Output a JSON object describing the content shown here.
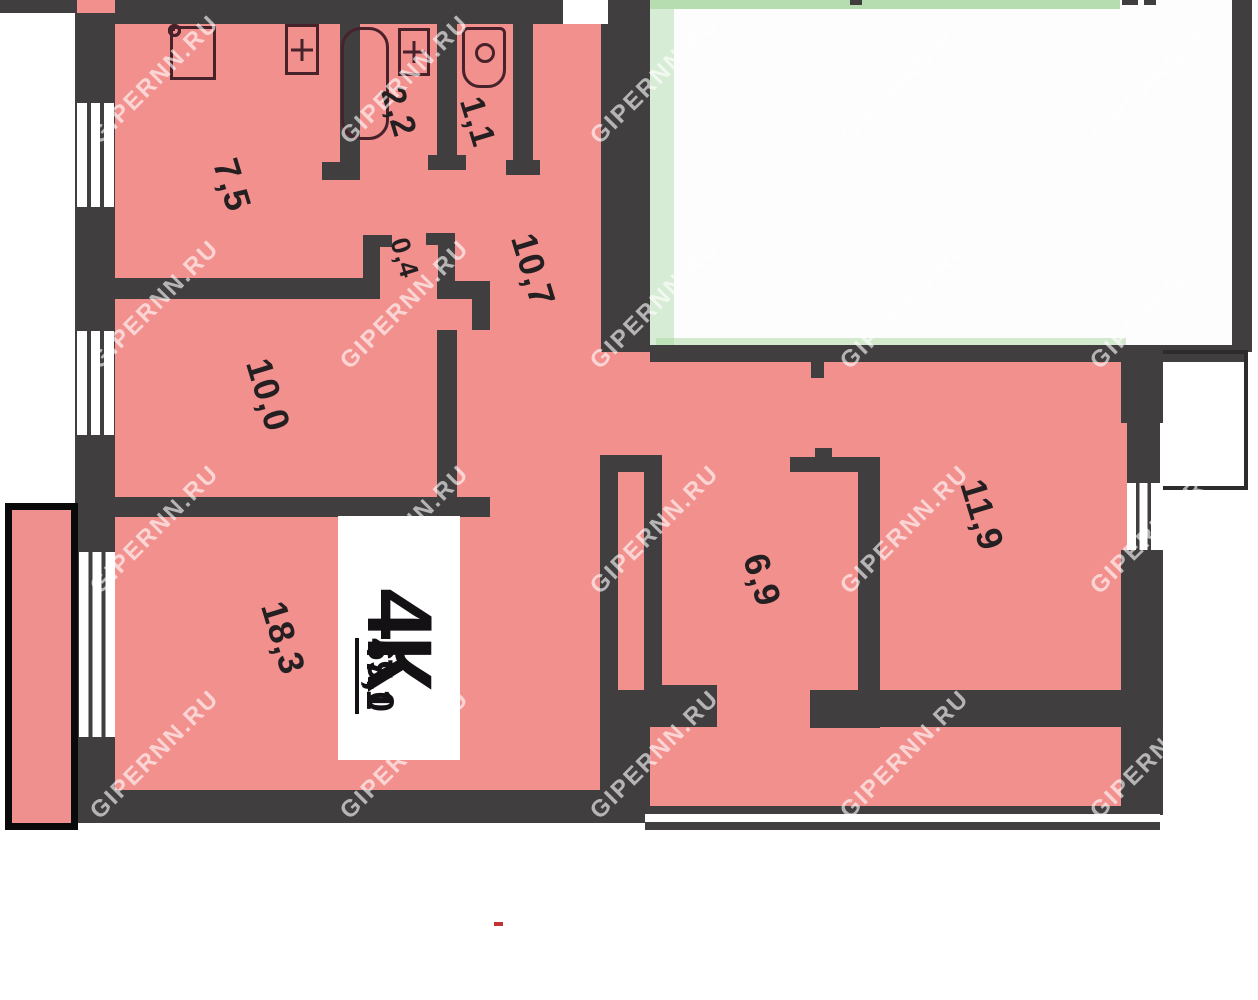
{
  "title": "Floor plan of 4-room apartment",
  "apartment": {
    "type_label": "4К",
    "total_area": "69,0",
    "living_area": "47,1"
  },
  "rooms": {
    "kitchen": "7,5",
    "bathroom": "2,2",
    "toilet": "1,1",
    "hallway": "10,7",
    "closet": "0,4",
    "bedroom_small": "10,0",
    "living_room": "18,3",
    "corridor": "6,9",
    "bedroom_right": "11,9"
  },
  "watermark": {
    "text": "GIPERNN.RU"
  },
  "icons": {
    "stove": "stove-icon",
    "kitchen_sink": "sink-plus-icon",
    "bath": "bathtub-icon",
    "bath_sink": "sink-plus-icon",
    "toilet": "toilet-icon"
  },
  "colors": {
    "wall": "#413e3f",
    "room_fill": "#f2908e",
    "fixture_line": "#47222a",
    "label_text": "#241f21",
    "accent_green": "#a9d7a1",
    "window_white": "#ffffff",
    "balcony_outline": "#0a0a0a",
    "red_mark": "#c23434"
  }
}
